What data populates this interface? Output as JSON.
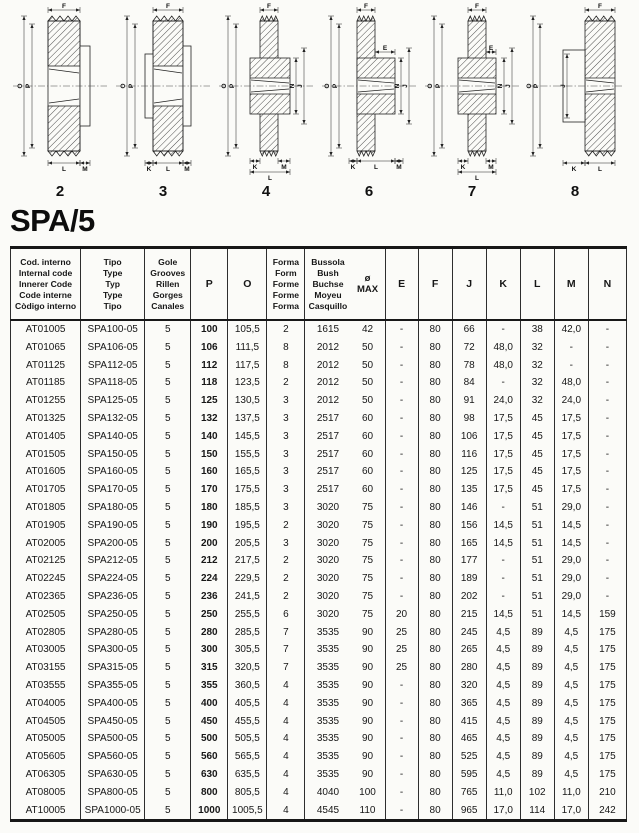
{
  "page": {
    "title": "SPA/5"
  },
  "diagrams": [
    {
      "form": "2",
      "labels": [
        "F",
        "O",
        "P",
        "L",
        "M"
      ]
    },
    {
      "form": "3",
      "labels": [
        "F",
        "O",
        "P",
        "K",
        "L",
        "M"
      ]
    },
    {
      "form": "4",
      "labels": [
        "F",
        "O",
        "P",
        "N",
        "J",
        "K",
        "M",
        "L"
      ]
    },
    {
      "form": "6",
      "labels": [
        "F",
        "E",
        "O",
        "P",
        "N",
        "J",
        "K",
        "L",
        "M"
      ]
    },
    {
      "form": "7",
      "labels": [
        "F",
        "E",
        "O",
        "P",
        "N",
        "J",
        "K",
        "M",
        "L"
      ]
    },
    {
      "form": "8",
      "labels": [
        "F",
        "O",
        "P",
        "J",
        "K",
        "L"
      ]
    }
  ],
  "table": {
    "header": {
      "cod": [
        "Cod. interno",
        "Internal code",
        "Innerer Code",
        "Code interne",
        "Còdigo interno"
      ],
      "tipo": [
        "Tipo",
        "Type",
        "Typ",
        "Type",
        "Tipo"
      ],
      "gole": [
        "Gole",
        "Grooves",
        "Rillen",
        "Gorges",
        "Canales"
      ],
      "p": "P",
      "o": "O",
      "forma": [
        "Forma",
        "Form",
        "Forme",
        "Forme",
        "Forma"
      ],
      "bussola": [
        "Bussola",
        "Bush",
        "Buchse",
        "Moyeu",
        "Casquillo"
      ],
      "omax": [
        "ø",
        "MAX"
      ],
      "letters": [
        "E",
        "F",
        "J",
        "K",
        "L",
        "M",
        "N"
      ]
    },
    "rows": [
      [
        "AT01005",
        "SPA100-05",
        "5",
        "100",
        "105,5",
        "2",
        "1615",
        "42",
        "-",
        "80",
        "66",
        "-",
        "38",
        "42,0",
        "-"
      ],
      [
        "AT01065",
        "SPA106-05",
        "5",
        "106",
        "111,5",
        "8",
        "2012",
        "50",
        "-",
        "80",
        "72",
        "48,0",
        "32",
        "-",
        "-"
      ],
      [
        "AT01125",
        "SPA112-05",
        "5",
        "112",
        "117,5",
        "8",
        "2012",
        "50",
        "-",
        "80",
        "78",
        "48,0",
        "32",
        "-",
        "-"
      ],
      [
        "AT01185",
        "SPA118-05",
        "5",
        "118",
        "123,5",
        "2",
        "2012",
        "50",
        "-",
        "80",
        "84",
        "-",
        "32",
        "48,0",
        "-"
      ],
      [
        "AT01255",
        "SPA125-05",
        "5",
        "125",
        "130,5",
        "3",
        "2012",
        "50",
        "-",
        "80",
        "91",
        "24,0",
        "32",
        "24,0",
        "-"
      ],
      [
        "AT01325",
        "SPA132-05",
        "5",
        "132",
        "137,5",
        "3",
        "2517",
        "60",
        "-",
        "80",
        "98",
        "17,5",
        "45",
        "17,5",
        "-"
      ],
      [
        "AT01405",
        "SPA140-05",
        "5",
        "140",
        "145,5",
        "3",
        "2517",
        "60",
        "-",
        "80",
        "106",
        "17,5",
        "45",
        "17,5",
        "-"
      ],
      [
        "AT01505",
        "SPA150-05",
        "5",
        "150",
        "155,5",
        "3",
        "2517",
        "60",
        "-",
        "80",
        "116",
        "17,5",
        "45",
        "17,5",
        "-"
      ],
      [
        "AT01605",
        "SPA160-05",
        "5",
        "160",
        "165,5",
        "3",
        "2517",
        "60",
        "-",
        "80",
        "125",
        "17,5",
        "45",
        "17,5",
        "-"
      ],
      [
        "AT01705",
        "SPA170-05",
        "5",
        "170",
        "175,5",
        "3",
        "2517",
        "60",
        "-",
        "80",
        "135",
        "17,5",
        "45",
        "17,5",
        "-"
      ],
      [
        "AT01805",
        "SPA180-05",
        "5",
        "180",
        "185,5",
        "3",
        "3020",
        "75",
        "-",
        "80",
        "146",
        "-",
        "51",
        "29,0",
        "-"
      ],
      [
        "AT01905",
        "SPA190-05",
        "5",
        "190",
        "195,5",
        "2",
        "3020",
        "75",
        "-",
        "80",
        "156",
        "14,5",
        "51",
        "14,5",
        "-"
      ],
      [
        "AT02005",
        "SPA200-05",
        "5",
        "200",
        "205,5",
        "3",
        "3020",
        "75",
        "-",
        "80",
        "165",
        "14,5",
        "51",
        "14,5",
        "-"
      ],
      [
        "AT02125",
        "SPA212-05",
        "5",
        "212",
        "217,5",
        "2",
        "3020",
        "75",
        "-",
        "80",
        "177",
        "-",
        "51",
        "29,0",
        "-"
      ],
      [
        "AT02245",
        "SPA224-05",
        "5",
        "224",
        "229,5",
        "2",
        "3020",
        "75",
        "-",
        "80",
        "189",
        "-",
        "51",
        "29,0",
        "-"
      ],
      [
        "AT02365",
        "SPA236-05",
        "5",
        "236",
        "241,5",
        "2",
        "3020",
        "75",
        "-",
        "80",
        "202",
        "-",
        "51",
        "29,0",
        "-"
      ],
      [
        "AT02505",
        "SPA250-05",
        "5",
        "250",
        "255,5",
        "6",
        "3020",
        "75",
        "20",
        "80",
        "215",
        "14,5",
        "51",
        "14,5",
        "159"
      ],
      [
        "AT02805",
        "SPA280-05",
        "5",
        "280",
        "285,5",
        "7",
        "3535",
        "90",
        "25",
        "80",
        "245",
        "4,5",
        "89",
        "4,5",
        "175"
      ],
      [
        "AT03005",
        "SPA300-05",
        "5",
        "300",
        "305,5",
        "7",
        "3535",
        "90",
        "25",
        "80",
        "265",
        "4,5",
        "89",
        "4,5",
        "175"
      ],
      [
        "AT03155",
        "SPA315-05",
        "5",
        "315",
        "320,5",
        "7",
        "3535",
        "90",
        "25",
        "80",
        "280",
        "4,5",
        "89",
        "4,5",
        "175"
      ],
      [
        "AT03555",
        "SPA355-05",
        "5",
        "355",
        "360,5",
        "4",
        "3535",
        "90",
        "-",
        "80",
        "320",
        "4,5",
        "89",
        "4,5",
        "175"
      ],
      [
        "AT04005",
        "SPA400-05",
        "5",
        "400",
        "405,5",
        "4",
        "3535",
        "90",
        "-",
        "80",
        "365",
        "4,5",
        "89",
        "4,5",
        "175"
      ],
      [
        "AT04505",
        "SPA450-05",
        "5",
        "450",
        "455,5",
        "4",
        "3535",
        "90",
        "-",
        "80",
        "415",
        "4,5",
        "89",
        "4,5",
        "175"
      ],
      [
        "AT05005",
        "SPA500-05",
        "5",
        "500",
        "505,5",
        "4",
        "3535",
        "90",
        "-",
        "80",
        "465",
        "4,5",
        "89",
        "4,5",
        "175"
      ],
      [
        "AT05605",
        "SPA560-05",
        "5",
        "560",
        "565,5",
        "4",
        "3535",
        "90",
        "-",
        "80",
        "525",
        "4,5",
        "89",
        "4,5",
        "175"
      ],
      [
        "AT06305",
        "SPA630-05",
        "5",
        "630",
        "635,5",
        "4",
        "3535",
        "90",
        "-",
        "80",
        "595",
        "4,5",
        "89",
        "4,5",
        "175"
      ],
      [
        "AT08005",
        "SPA800-05",
        "5",
        "800",
        "805,5",
        "4",
        "4040",
        "100",
        "-",
        "80",
        "765",
        "11,0",
        "102",
        "11,0",
        "210"
      ],
      [
        "AT10005",
        "SPA1000-05",
        "5",
        "1000",
        "1005,5",
        "4",
        "4545",
        "110",
        "-",
        "80",
        "965",
        "17,0",
        "114",
        "17,0",
        "242"
      ]
    ]
  }
}
